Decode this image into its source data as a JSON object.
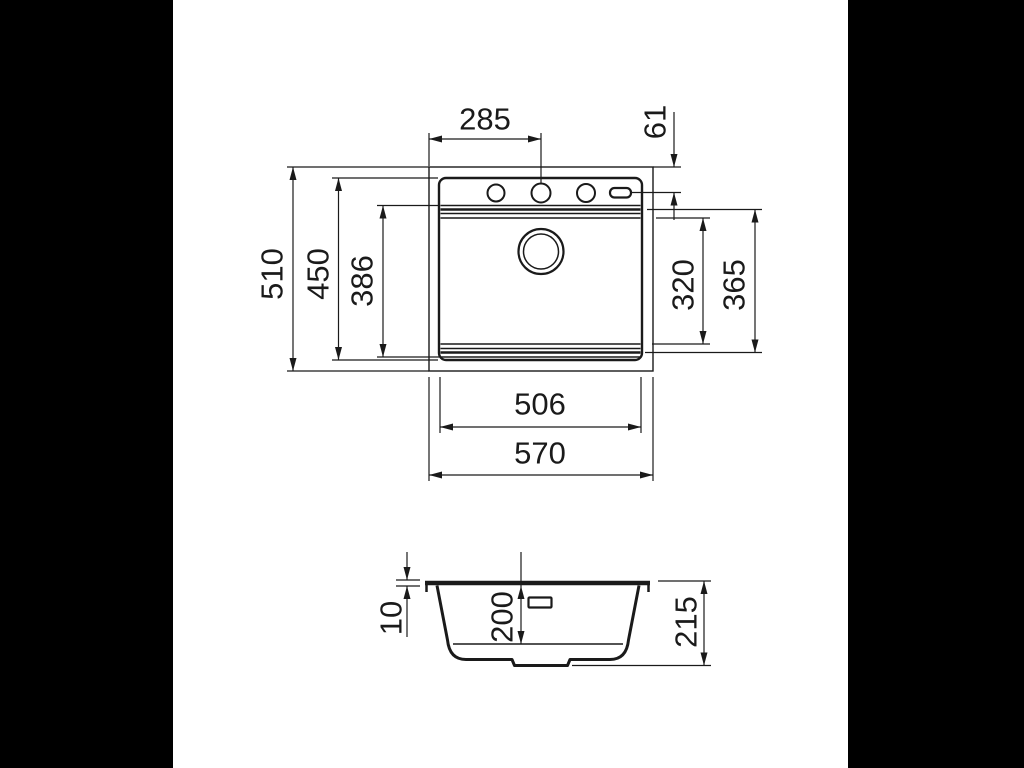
{
  "page": {
    "background_color": "#ffffff",
    "letterbox_color": "#000000",
    "line_color": "#1a1a1a"
  },
  "drawing": {
    "top_view": {
      "dim_faucet_center_from_left": "285",
      "dim_faucet_center_from_back": "61",
      "dim_overall_depth": "510",
      "dim_body_depth": "450",
      "dim_bowl_depth": "386",
      "dim_bowl_opening_depth": "320",
      "dim_bowl_outer_depth": "365",
      "dim_body_width": "506",
      "dim_overall_width": "570"
    },
    "section_view": {
      "dim_rim_thickness": "10",
      "dim_bowl_inner_height": "200",
      "dim_overall_height": "215"
    }
  }
}
